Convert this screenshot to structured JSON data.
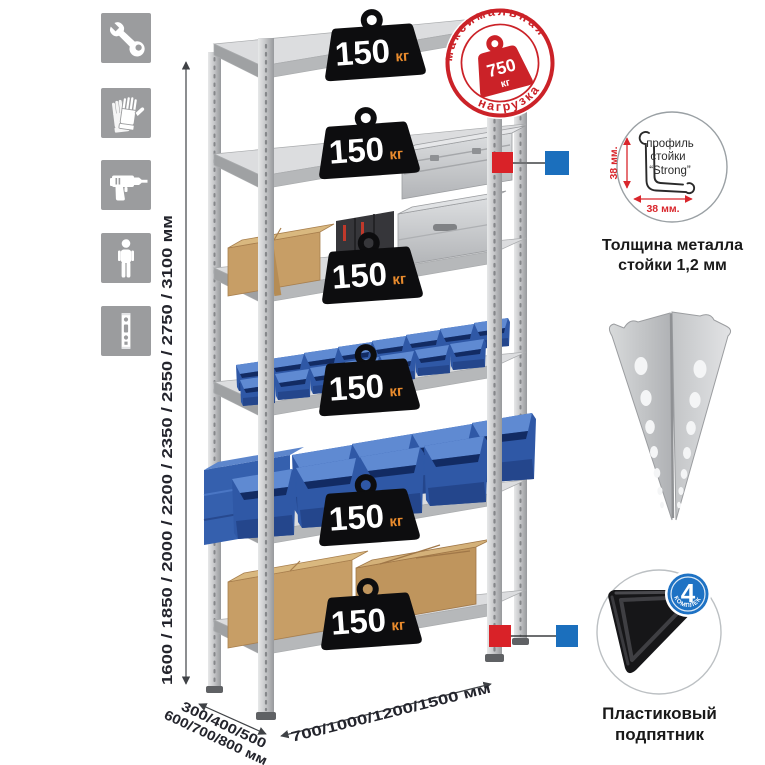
{
  "colors": {
    "stamp_red": "#cb2228",
    "badge_black": "#0d0d0f",
    "badge_unit_orange": "#e98b2d",
    "bin_blue": "#3560ae",
    "marker_red": "#d92228",
    "marker_blue": "#1b6fbd",
    "icon_gray": "#9b9c9e",
    "metal_gray": "#c9cacc",
    "dimension_text": "#23242c"
  },
  "sidebar": {
    "icons": [
      {
        "name": "wrench-icon"
      },
      {
        "name": "work-gloves-icon"
      },
      {
        "name": "drill-icon"
      },
      {
        "name": "person-icon"
      },
      {
        "name": "perforated-profile-icon"
      }
    ]
  },
  "dimensions": {
    "height_label": "1600 / 1850 / 2000 / 2200 / 2350 / 2550 / 2750 / 3100 мм",
    "depth_line1": "300/400/500",
    "depth_line2": "600/700/800 мм",
    "width_label": "700/1000/1200/1500 мм"
  },
  "max_load_stamp": {
    "arc_top": "максимальная",
    "arc_bottom": "нагрузка",
    "value": "750",
    "unit": "кг"
  },
  "shelf_badges": [
    {
      "value": "150",
      "unit": "кг"
    },
    {
      "value": "150",
      "unit": "кг"
    },
    {
      "value": "150",
      "unit": "кг"
    },
    {
      "value": "150",
      "unit": "кг"
    },
    {
      "value": "150",
      "unit": "кг"
    },
    {
      "value": "150",
      "unit": "кг"
    }
  ],
  "profile_detail": {
    "line1": "профиль",
    "line2": "стойки",
    "line3": "“Strong”",
    "dim_vertical": "38 мм.",
    "dim_horizontal": "38 мм.",
    "caption1": "Толщина металла",
    "caption2": "стойки 1,2 мм"
  },
  "foot_detail": {
    "badge_value": "4",
    "badge_caption": "в комплекте",
    "caption1": "Пластиковый",
    "caption2": "подпятник"
  }
}
